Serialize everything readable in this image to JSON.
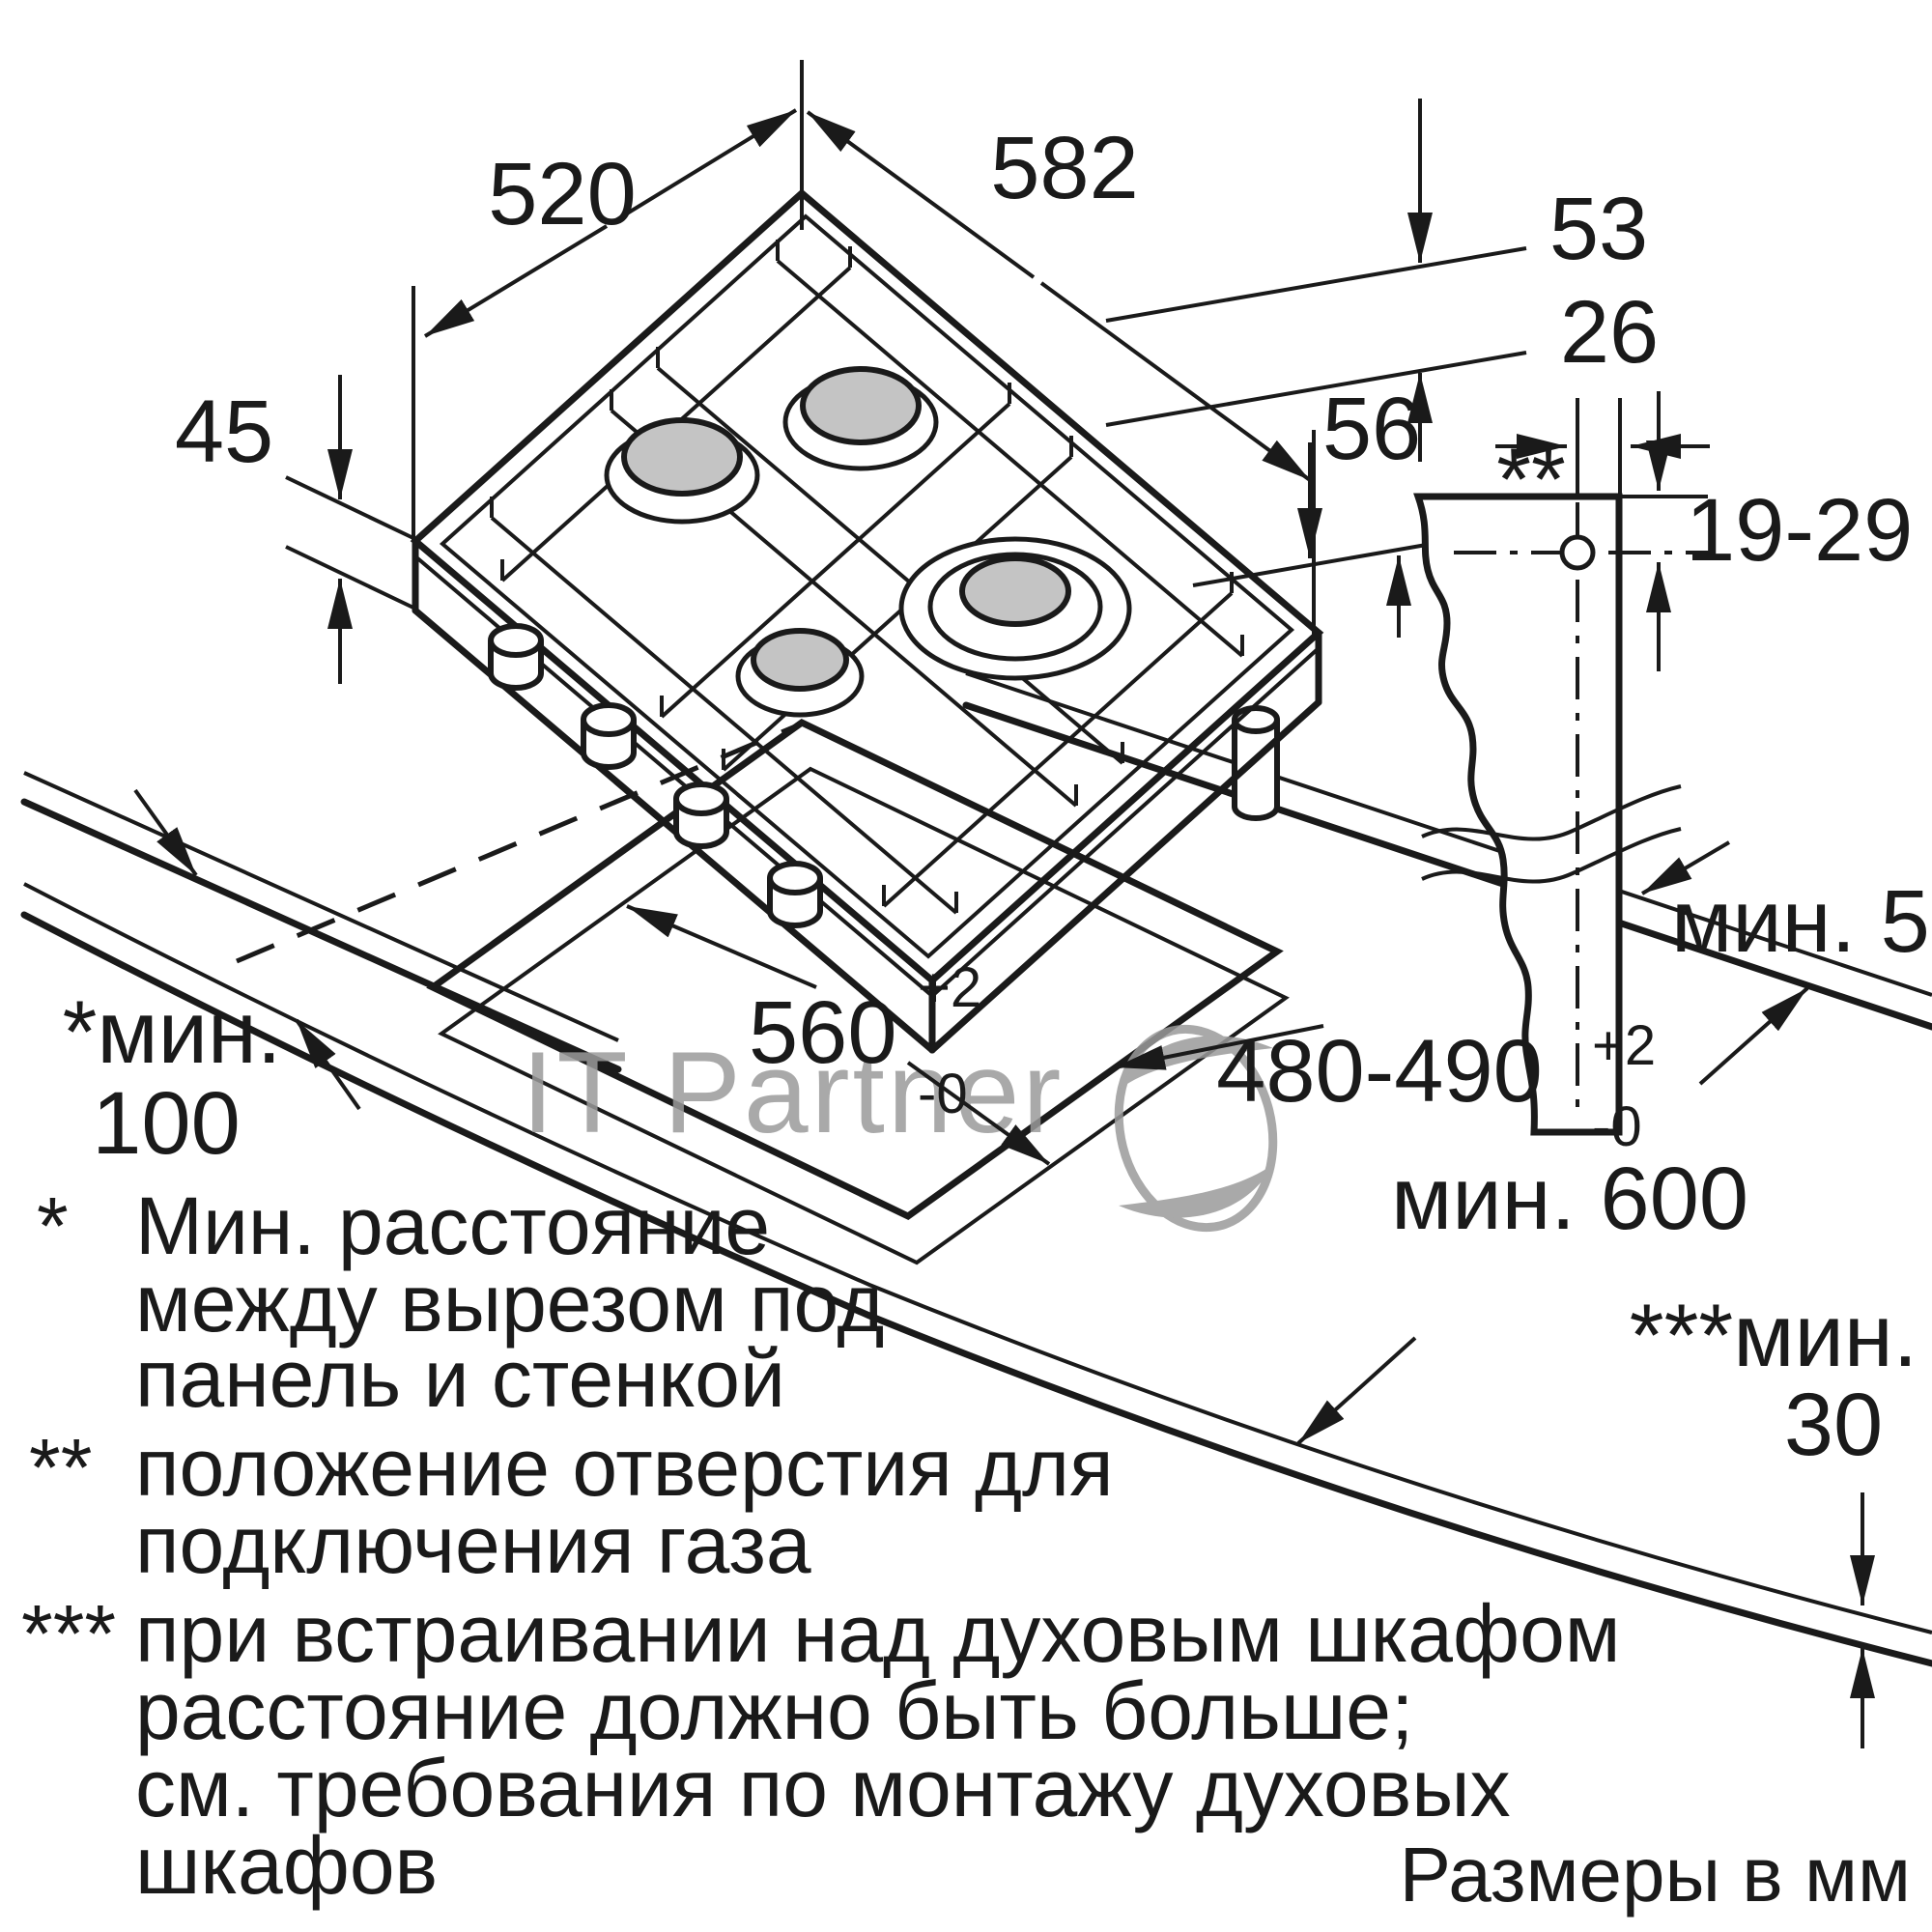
{
  "watermark": {
    "text": "IT Partner"
  },
  "colors": {
    "line": "#1a1a1a",
    "burner_cap": "#c4c4c4",
    "watermark_gray": "#9b9b9b"
  },
  "hob_dims": {
    "width": "582",
    "depth": "520",
    "side_gap": "53",
    "height": "45",
    "body_depth": "56"
  },
  "detail_dims": {
    "hole_offset": "26",
    "hole_marker": "**",
    "hole_height_range": "19-29",
    "min_back_clearance": "мин. 50"
  },
  "cutout_dims": {
    "width": "560",
    "depth_range": "480-490",
    "tol_plus": "+2",
    "tol_minus": "-0",
    "min_side_label": "*мин.",
    "min_side_value": "100",
    "min_worktop_depth": "мин. 600",
    "min_oven_label": "***мин.",
    "min_oven_value": "30"
  },
  "footnotes": [
    {
      "marker": "*",
      "lines": [
        "Мин. расстояние",
        "между вырезом под",
        "панель и стенкой"
      ]
    },
    {
      "marker": "**",
      "lines": [
        "положение отверстия для",
        "подключения газа"
      ]
    },
    {
      "marker": "***",
      "lines": [
        "при встраивании над духовым шкафом",
        "расстояние должно быть больше;",
        "см. требования по монтажу духовых",
        "шкафов"
      ]
    }
  ],
  "units_note": "Размеры в мм"
}
